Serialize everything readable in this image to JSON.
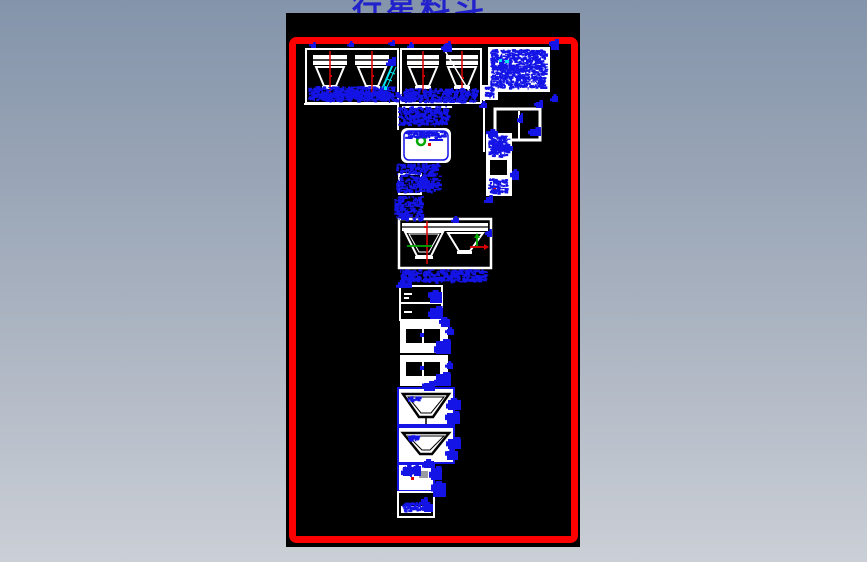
{
  "title": {
    "text": "行星料斗",
    "color": "#2222cc"
  },
  "background": {
    "gradient_top": "#8494aa",
    "gradient_bottom": "#cbcfd6"
  },
  "canvas": {
    "background": "#000000",
    "frame_color": "#ff0000"
  },
  "drawing": {
    "colors": {
      "annotation": "#1414e6",
      "outline": "#ffffff",
      "centerline": "#dd0000",
      "highlight_cyan": "#00e5ee",
      "marker_green": "#00aa00"
    },
    "blocks": [
      {
        "name": "hopper-front-views-left"
      },
      {
        "name": "hopper-front-views-right"
      },
      {
        "name": "parts-note-table"
      },
      {
        "name": "detail-box"
      },
      {
        "name": "component-card"
      },
      {
        "name": "side-annotation-strip"
      },
      {
        "name": "hopper-section-pair"
      },
      {
        "name": "plan-view-upper"
      },
      {
        "name": "plan-view-lower"
      },
      {
        "name": "funnel-detail-upper"
      },
      {
        "name": "funnel-detail-lower"
      },
      {
        "name": "fitting-detail"
      },
      {
        "name": "base-detail"
      }
    ]
  }
}
